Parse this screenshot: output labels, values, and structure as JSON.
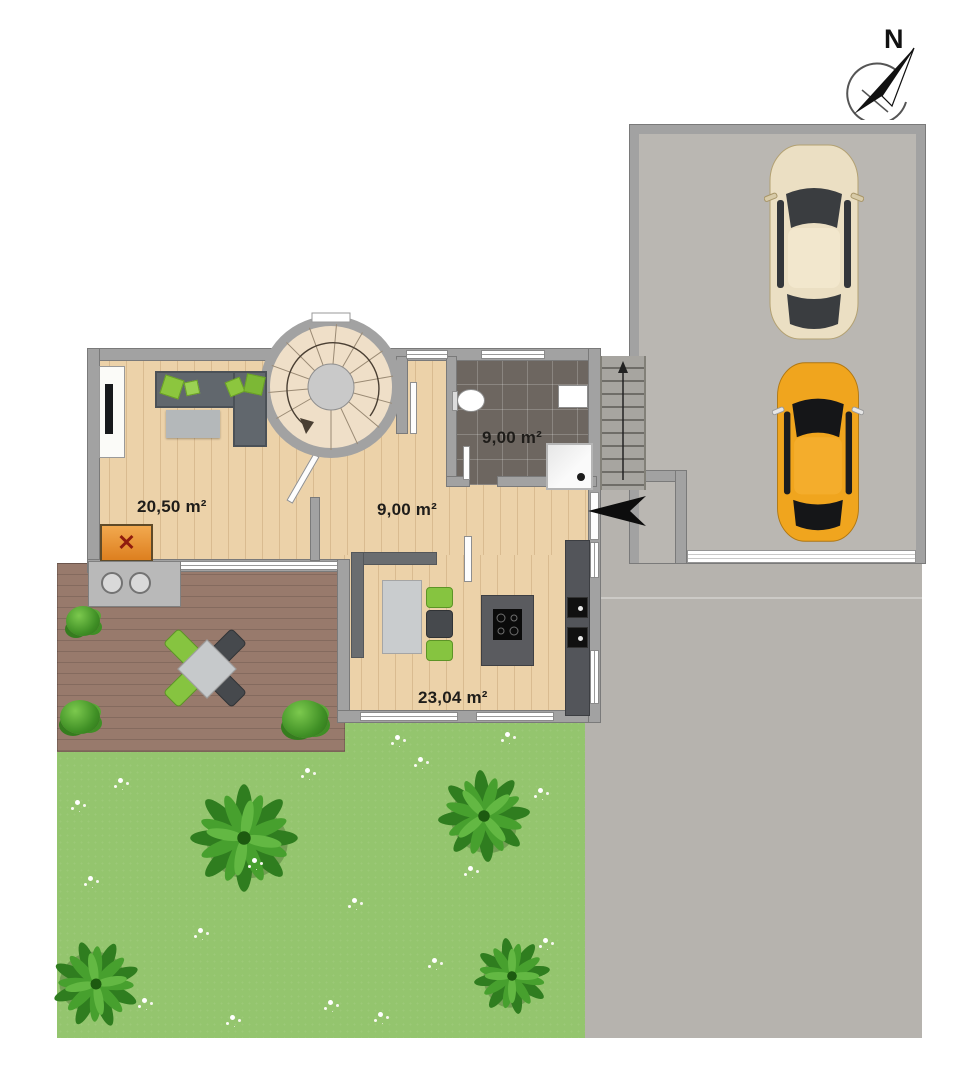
{
  "compass": {
    "north_label": "N"
  },
  "rooms": [
    {
      "id": "living-room",
      "area_label": "20,50 m²"
    },
    {
      "id": "hallway",
      "area_label": "9,00 m²"
    },
    {
      "id": "bathroom",
      "area_label": "9,00 m²"
    },
    {
      "id": "kitchen-dining",
      "area_label": "23,04 m²"
    }
  ],
  "fireplace": {
    "mark": "✕"
  },
  "icons": {
    "compass": "north-arrow-compass",
    "entrance_arrow": "left-pointing-entrance-arrow",
    "exterior_stairs": "up-arrow-staircase",
    "spiral_staircase": "spiral-stairs",
    "fireplace": "orange-box-with-cross",
    "cars": [
      "beige-car-top-view",
      "orange-car-top-view"
    ]
  },
  "colors": {
    "wall": "#a2a2a2",
    "wood_floor": "#ecd2a9",
    "bath_tiles": "#6d6660",
    "deck_wood": "#987a6c",
    "lawn": "#94c56e",
    "paving": "#b6b3ae",
    "accent_green": "#8cc63e",
    "sofa": "#61676d",
    "car_beige": "#ebdfc3",
    "car_orange": "#f0a51e",
    "fireplace_orange": "#e8944a"
  }
}
